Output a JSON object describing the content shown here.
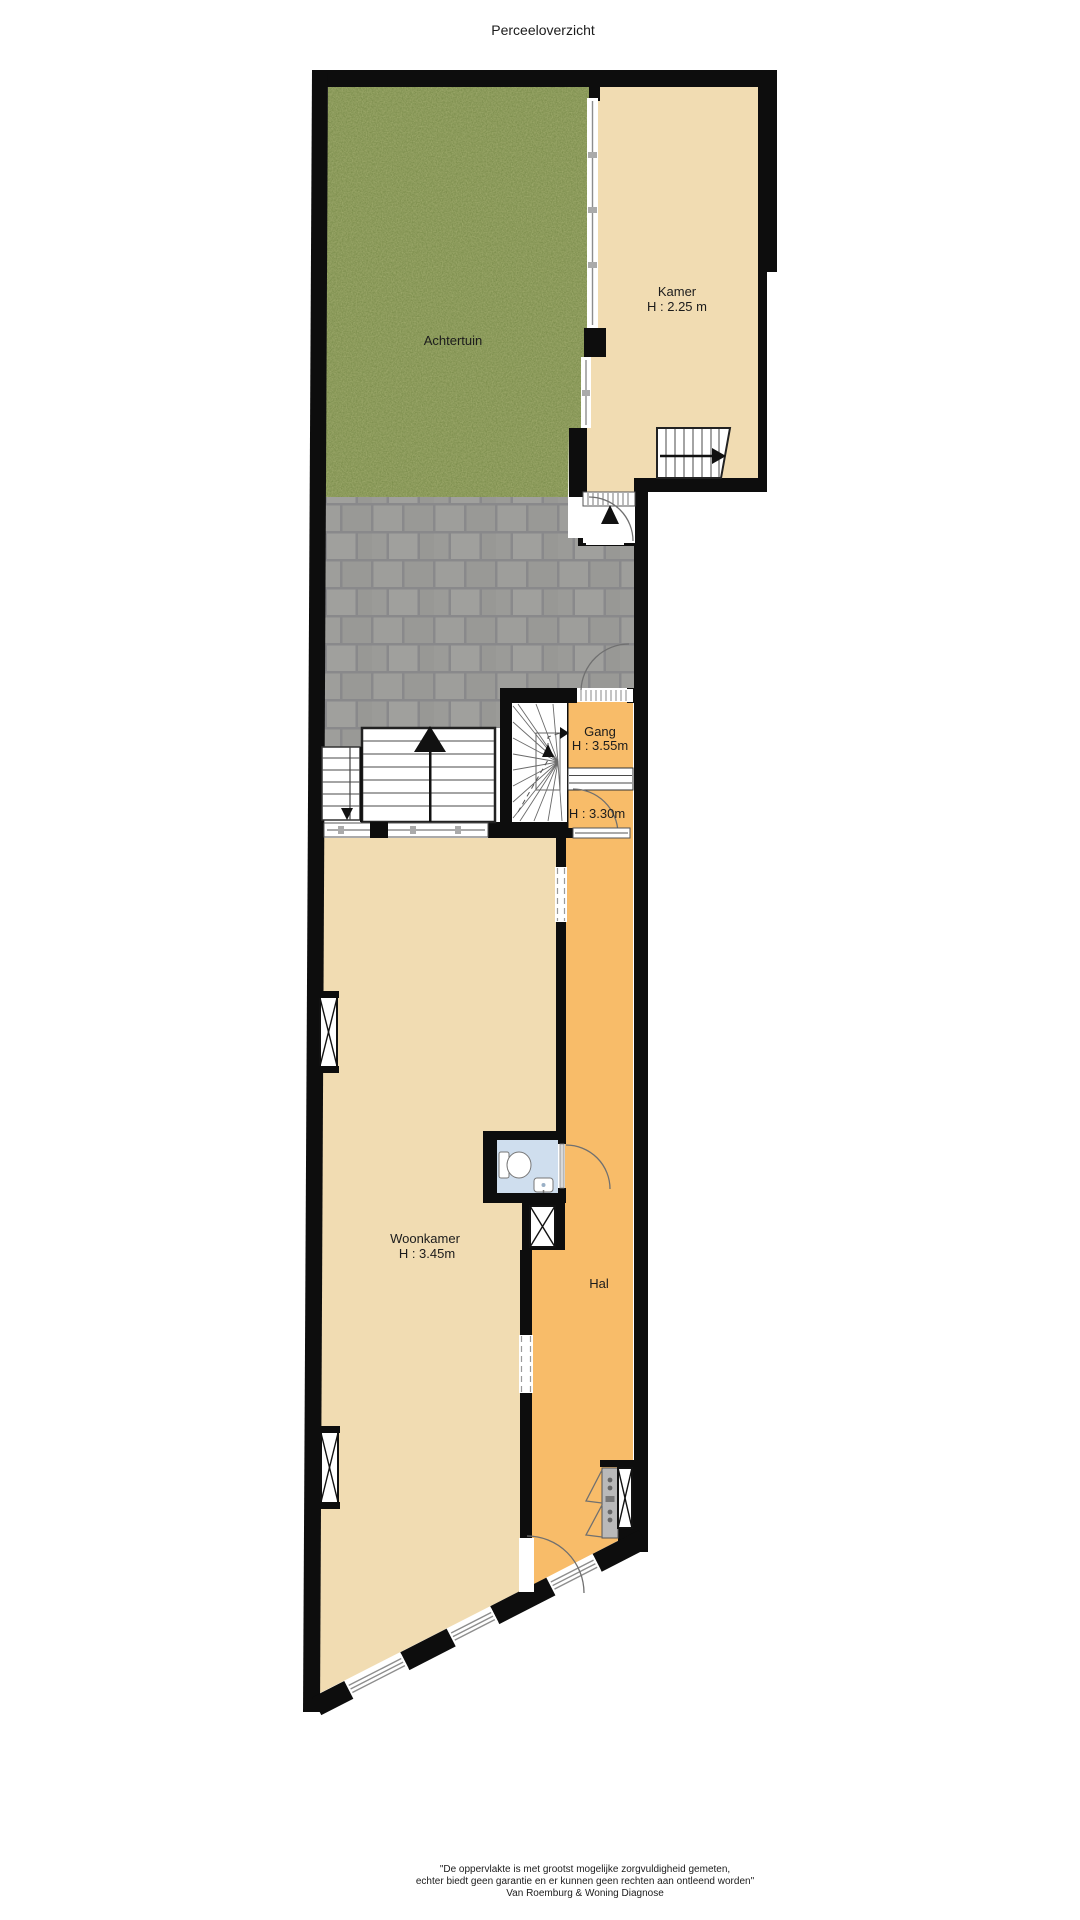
{
  "title": "Perceeloverzicht",
  "rooms": {
    "achtertuin": {
      "label": "Achtertuin"
    },
    "kamer": {
      "label": "Kamer",
      "height": "H : 2.25 m"
    },
    "gang": {
      "label": "Gang",
      "height": "H : 3.55m"
    },
    "vestibule": {
      "height": "H : 3.30m"
    },
    "woonkamer": {
      "label": "Woonkamer",
      "height": "H : 3.45m"
    },
    "hal": {
      "label": "Hal"
    }
  },
  "footer": {
    "line1": "\"De oppervlakte is met grootst mogelijke zorgvuldigheid gemeten,",
    "line2": "echter biedt geen garantie en er kunnen geen rechten aan ontleend worden\"",
    "line3": "Van Roemburg & Woning Diagnose"
  },
  "colors": {
    "wall": "#0d0d0d",
    "garden": "#7a8c4b",
    "paving": "#9c9c9a",
    "paving_joint": "#89898b",
    "beige": "#f1dcb2",
    "orange": "#f8bc69",
    "bath_blue": "#cfdeee",
    "white": "#ffffff",
    "line_gray": "#8d8d8d",
    "arc_gray": "#707070",
    "text": "#1c1c1c",
    "cabinet_gray": "#b9b9b9"
  }
}
